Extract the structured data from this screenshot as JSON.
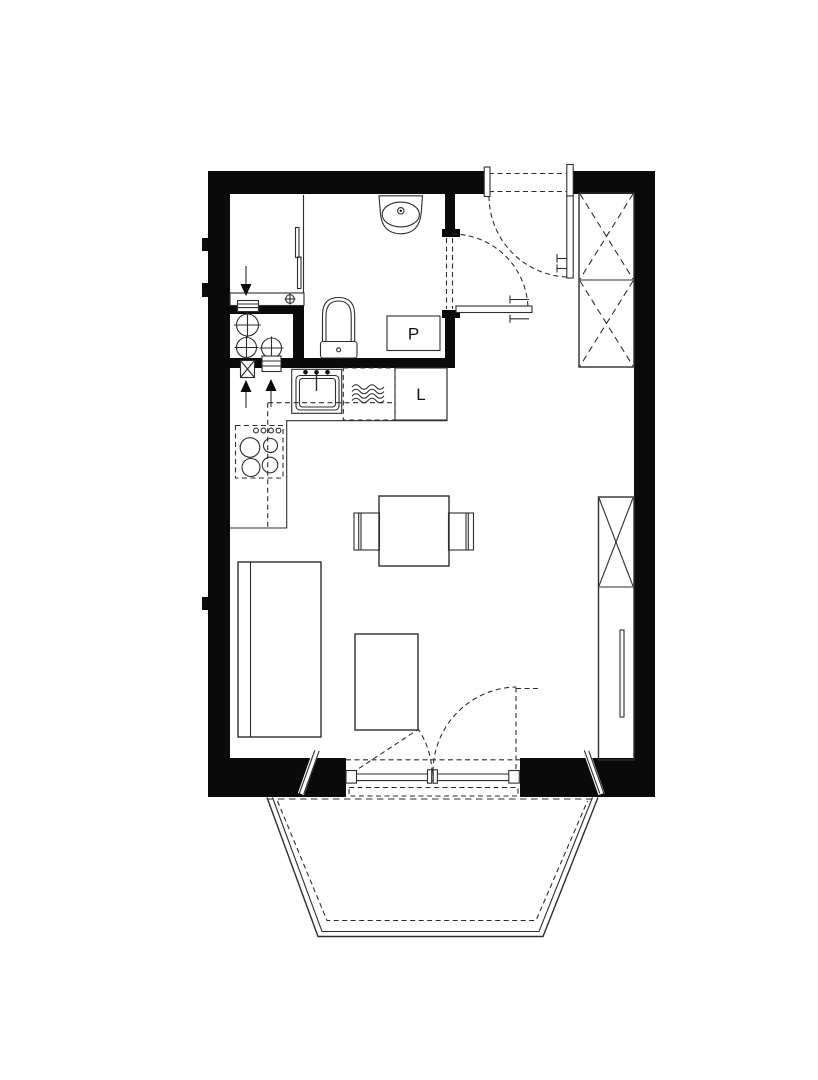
{
  "plan": {
    "type": "apartment-floor-plan",
    "labels": {
      "washing_machine": "P",
      "fridge": "L"
    },
    "colors": {
      "wall": "#0a0a0a",
      "line": "#2e2e2e",
      "background": "#ffffff"
    },
    "fixtures": [
      "bathroom-sink-icon",
      "toilet-icon",
      "washing-machine-icon",
      "shower-threshold-icon",
      "plumbing-riser-icon",
      "ventilation-arrow-icon",
      "kitchen-sink-icon",
      "dishwasher-icon",
      "fridge-icon",
      "stove-icon",
      "wardrobe-x-icon",
      "dining-table-icon",
      "chair-icon",
      "sofa-icon",
      "ottoman-icon",
      "door-swing-icon",
      "balcony-railing-icon"
    ]
  }
}
